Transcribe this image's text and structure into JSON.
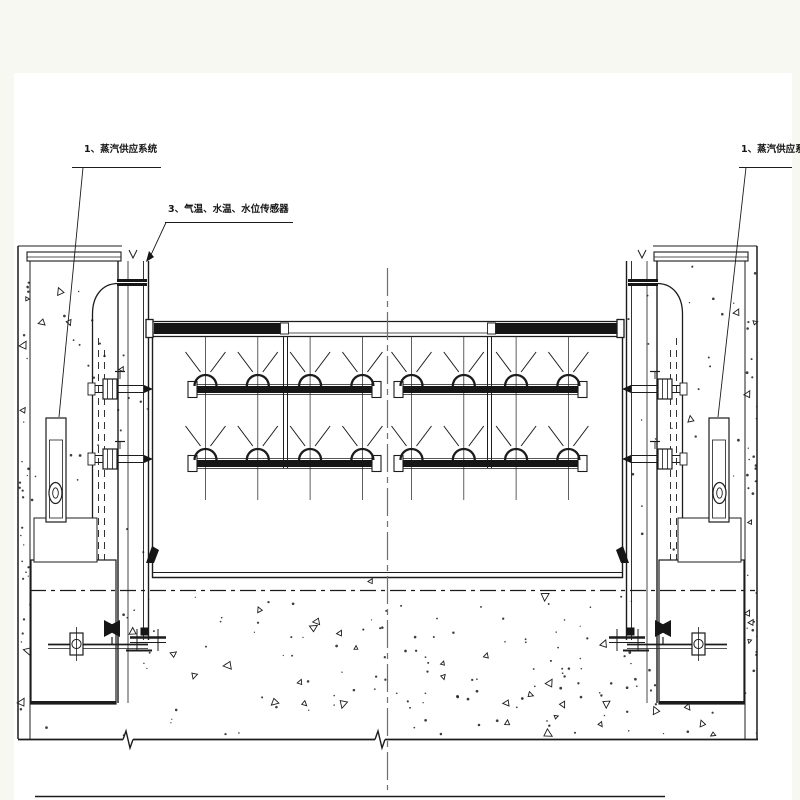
{
  "drawing": {
    "labels": {
      "left_system": "1、蒸汽供应系统",
      "sensors": "3、气温、水温、水位传感器",
      "right_system": "1、蒸汽供应系统"
    },
    "colors": {
      "line": "#1c1c1c",
      "fill_dark": "#161616",
      "paper": "#ffffff",
      "frame_bg": "#f7f8f2",
      "centerline": "#6f6f6f"
    }
  }
}
